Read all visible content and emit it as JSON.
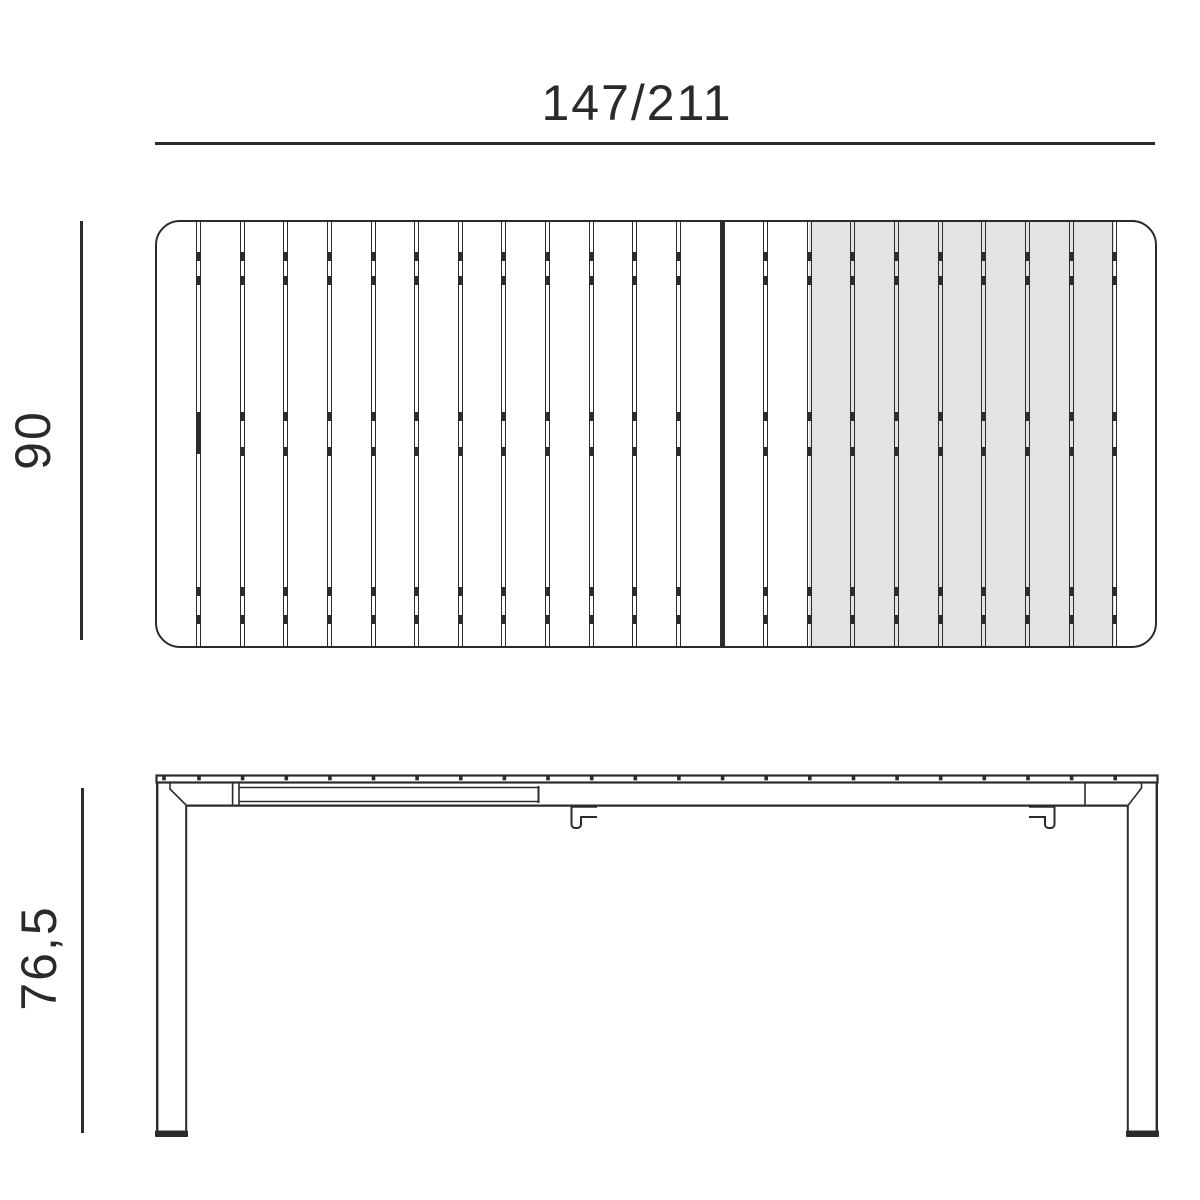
{
  "labels": {
    "top_width": "147/211",
    "side_depth": "90",
    "side_height": "76,5"
  },
  "colors": {
    "line": "#2b2b2b",
    "text": "#2a2a2a",
    "extension_fill": "#e2e3e3",
    "background": "#ffffff"
  },
  "top_view": {
    "slat_count": 23,
    "extension_slat_count": 7,
    "divider_count": 22,
    "divider_start": 41.5,
    "divider_spacing": 43.63,
    "solid_divider_index": 12,
    "handle_divider_index": 0,
    "tick_y": [
      30,
      54,
      190,
      225,
      365,
      393
    ],
    "tick_height": 9,
    "handle_bar": {
      "y": 190,
      "height": 42
    },
    "extension_overlay": {
      "left": 652,
      "width": 305
    }
  },
  "side_view": {
    "tick_start": 199,
    "tick_spacing": 43.63,
    "tick_count": 22,
    "tick_xs_extra": [
      164
    ]
  }
}
